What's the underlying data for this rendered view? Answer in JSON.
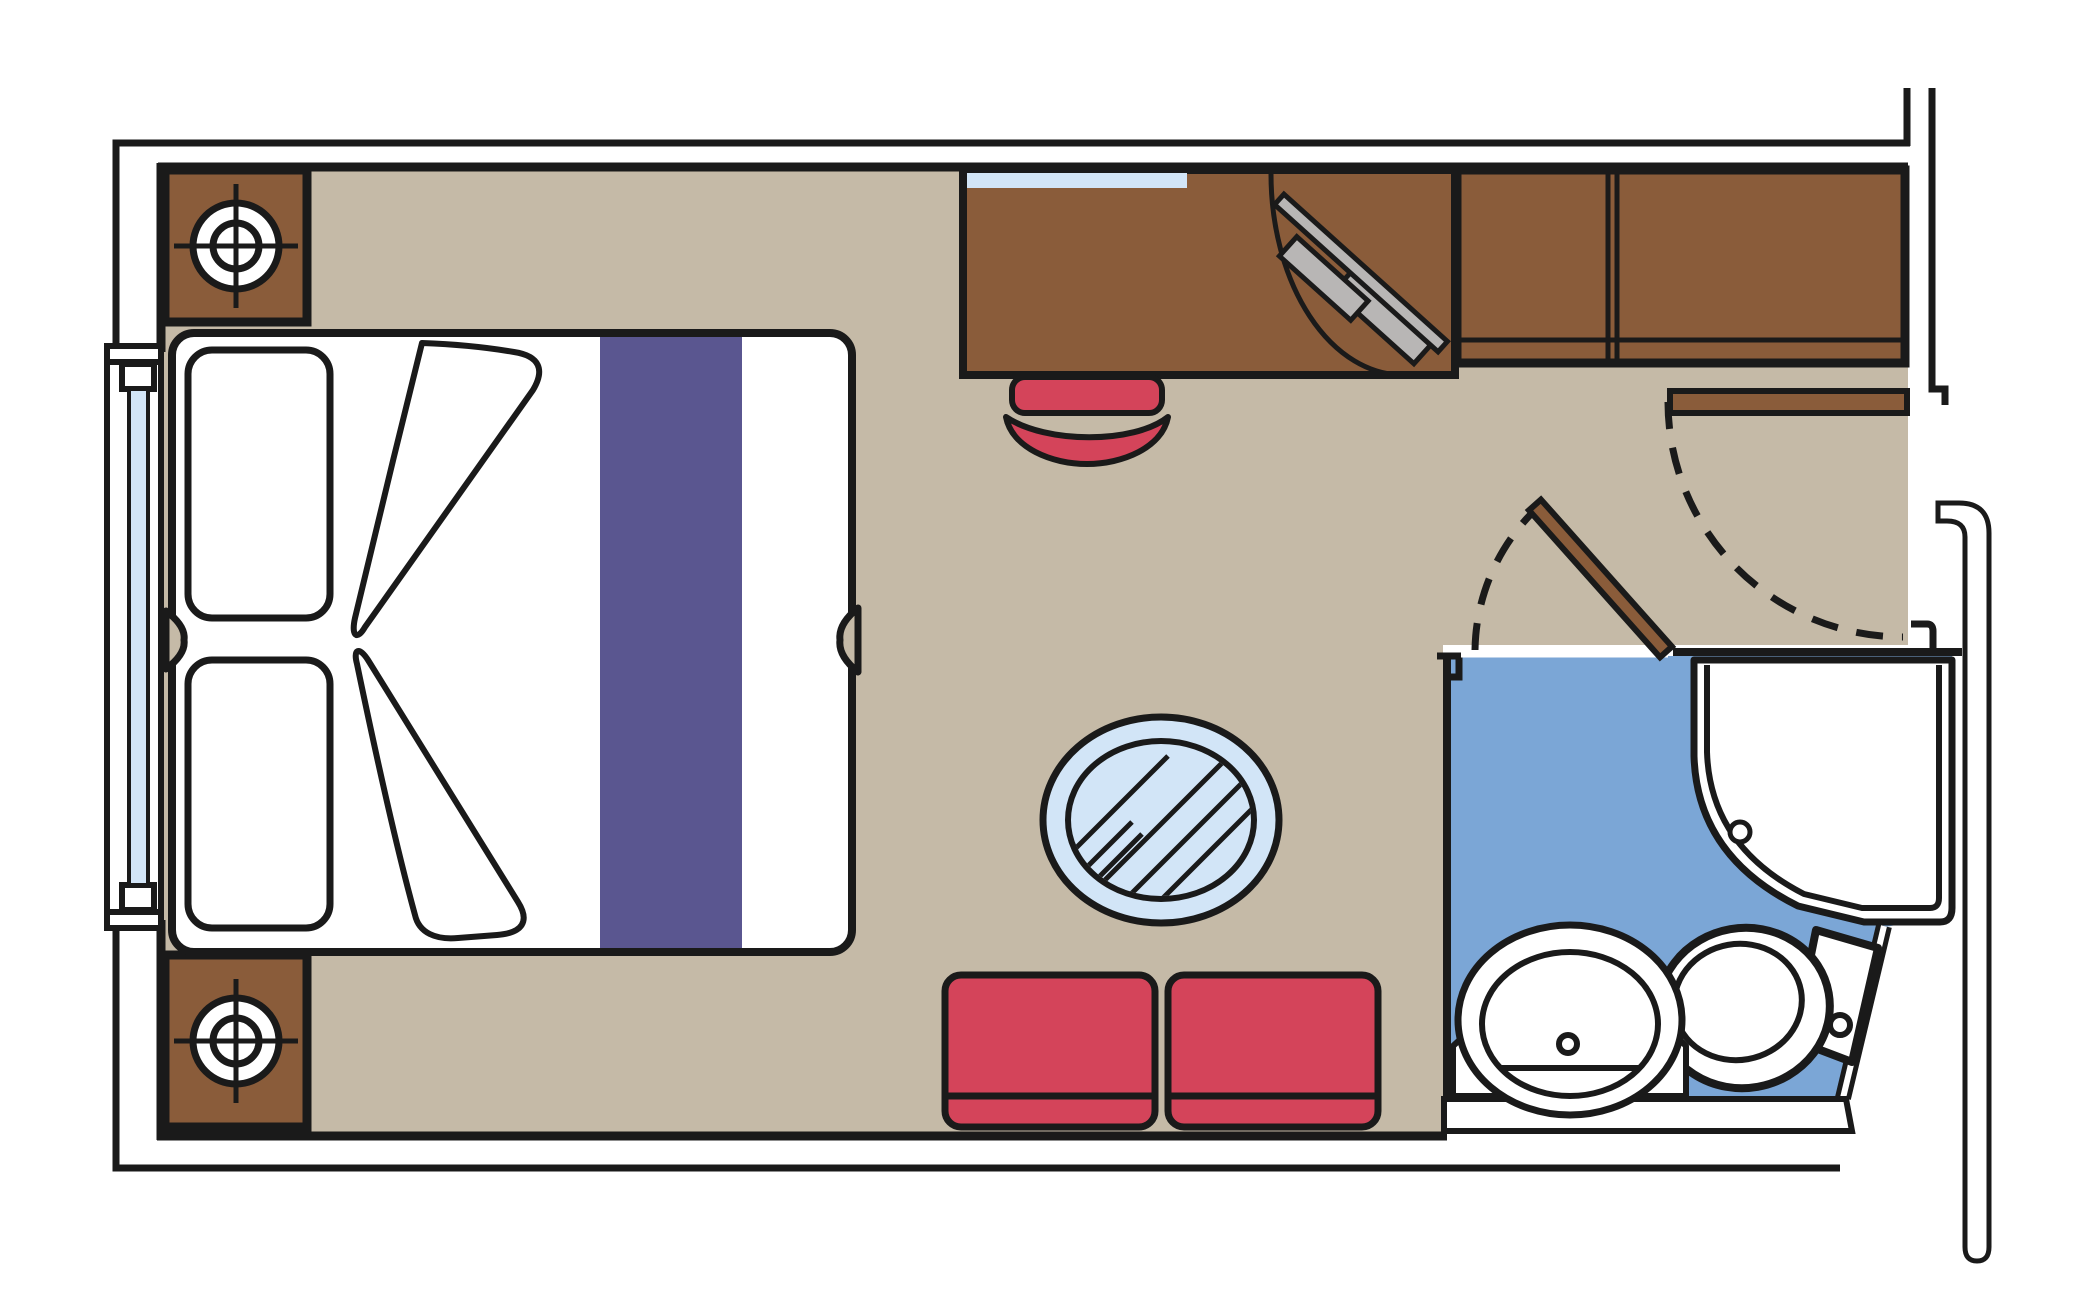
{
  "diagram": {
    "kind": "floor-plan",
    "subject": "cruise-cabin-stateroom-top-view",
    "visible_text": []
  },
  "colors": {
    "line": "#1a1a1a",
    "white": "#ffffff",
    "floor": "#c5baa7",
    "wood": "#8a5c3a",
    "bed_runner": "#5a5690",
    "upholstery_red": "#d4445a",
    "glass_blue": "#d2e5f7",
    "bathroom_floor": "#7ba6d6",
    "metal_gray": "#b8b6b5"
  },
  "objects": {
    "bed": "double-bed-with-split-notches",
    "pillows": "two-pillows",
    "runner": "bed-runner-stripe",
    "duvet": "folded-duvet-wedges",
    "nightstands": "two-nightstands-with-lamp-symbol",
    "window": "panoramic-window-left-wall",
    "desk": "desk-with-mirror-and-cabinet",
    "tv": "swivel-tv-on-bracket",
    "stool": "red-stool",
    "wardrobe": "two-door-wardrobe",
    "entrance_door": "entrance-door-open-with-swing-arc",
    "bathroom_door": "bathroom-door-open-with-swing-arc",
    "shower": "corner-shower-stall-with-drain",
    "washbasin": "oval-washbasin-on-counter-with-faucet",
    "toilet": "toilet-with-tank-and-flush-button",
    "table": "round-glass-table",
    "chairs": "two-red-armchairs",
    "corridor": "corridor-walls-right-side"
  }
}
